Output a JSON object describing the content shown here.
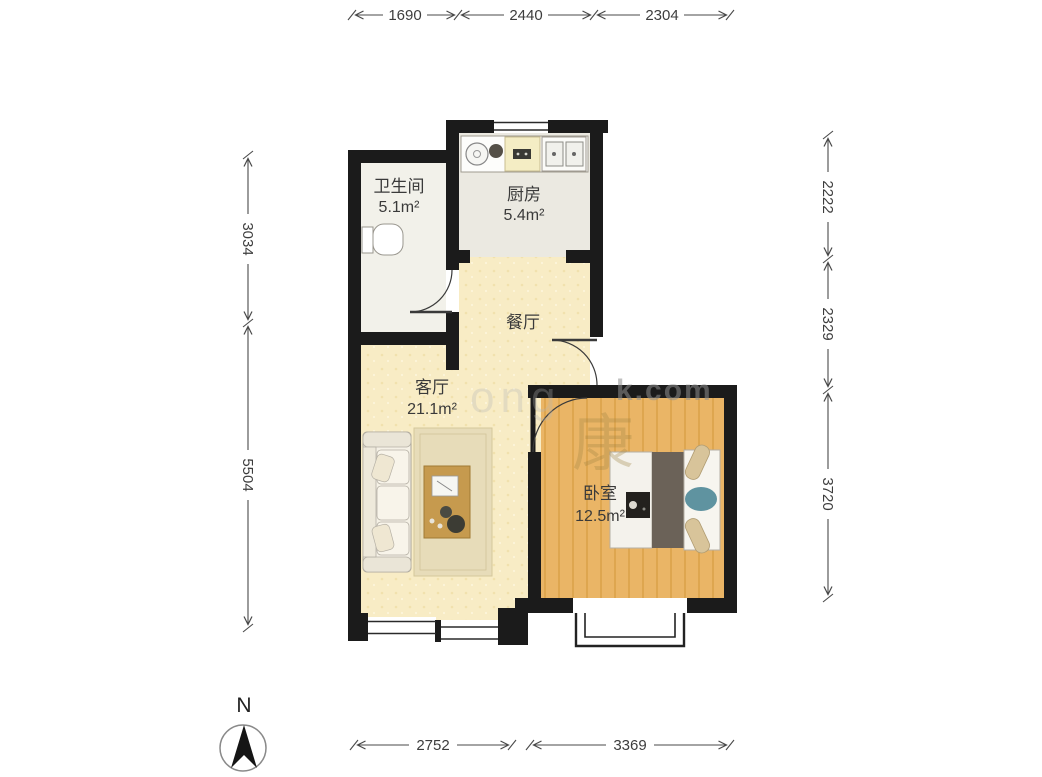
{
  "compass": {
    "label": "N"
  },
  "rooms": {
    "bathroom": {
      "name": "卫生间",
      "area": "5.1m²"
    },
    "kitchen": {
      "name": "厨房",
      "area": "5.4m²"
    },
    "dining": {
      "name": "餐厅"
    },
    "living": {
      "name": "客厅",
      "area": "21.1m²"
    },
    "bedroom": {
      "name": "卧室",
      "area": "12.5m²"
    }
  },
  "dimensions": {
    "top": [
      "1690",
      "2440",
      "2304"
    ],
    "right": [
      "2222",
      "2329",
      "3720"
    ],
    "left": [
      "3034",
      "5504"
    ],
    "bottom": [
      "2752",
      "3369"
    ]
  },
  "watermark": {
    "latin": "ong",
    "domain": "k.com",
    "cn": "康"
  },
  "colors": {
    "wall": "#1b1b1b",
    "floor_warm": "#f8ecc5",
    "floor_wood": "#eab566",
    "floor_tile": "#f0efe8",
    "dim_line": "#4a4a4a"
  }
}
